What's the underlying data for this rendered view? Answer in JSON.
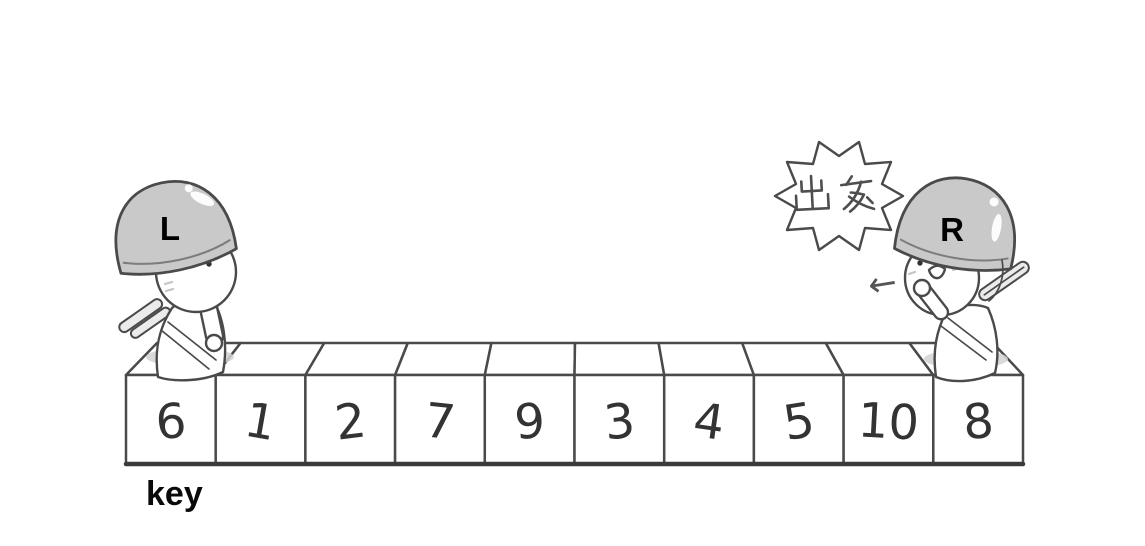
{
  "scene": {
    "array": {
      "key_label": "key",
      "cells": [
        "6",
        "1",
        "2",
        "7",
        "9",
        "3",
        "4",
        "5",
        "10",
        "8"
      ]
    },
    "pointers": {
      "left_label": "L",
      "right_label": "R"
    },
    "speech_bubble": {
      "text": "出发"
    },
    "arrow": {
      "symbol": "←"
    }
  },
  "colors": {
    "background": "#ffffff",
    "outline": "#4a4a4a",
    "ink": "#333333",
    "helmet_fill": "#c9c9c9",
    "shadow_fill": "#d2d2d2",
    "stick_fill": "#ebebeb",
    "label_color": "#0a0a0a"
  }
}
